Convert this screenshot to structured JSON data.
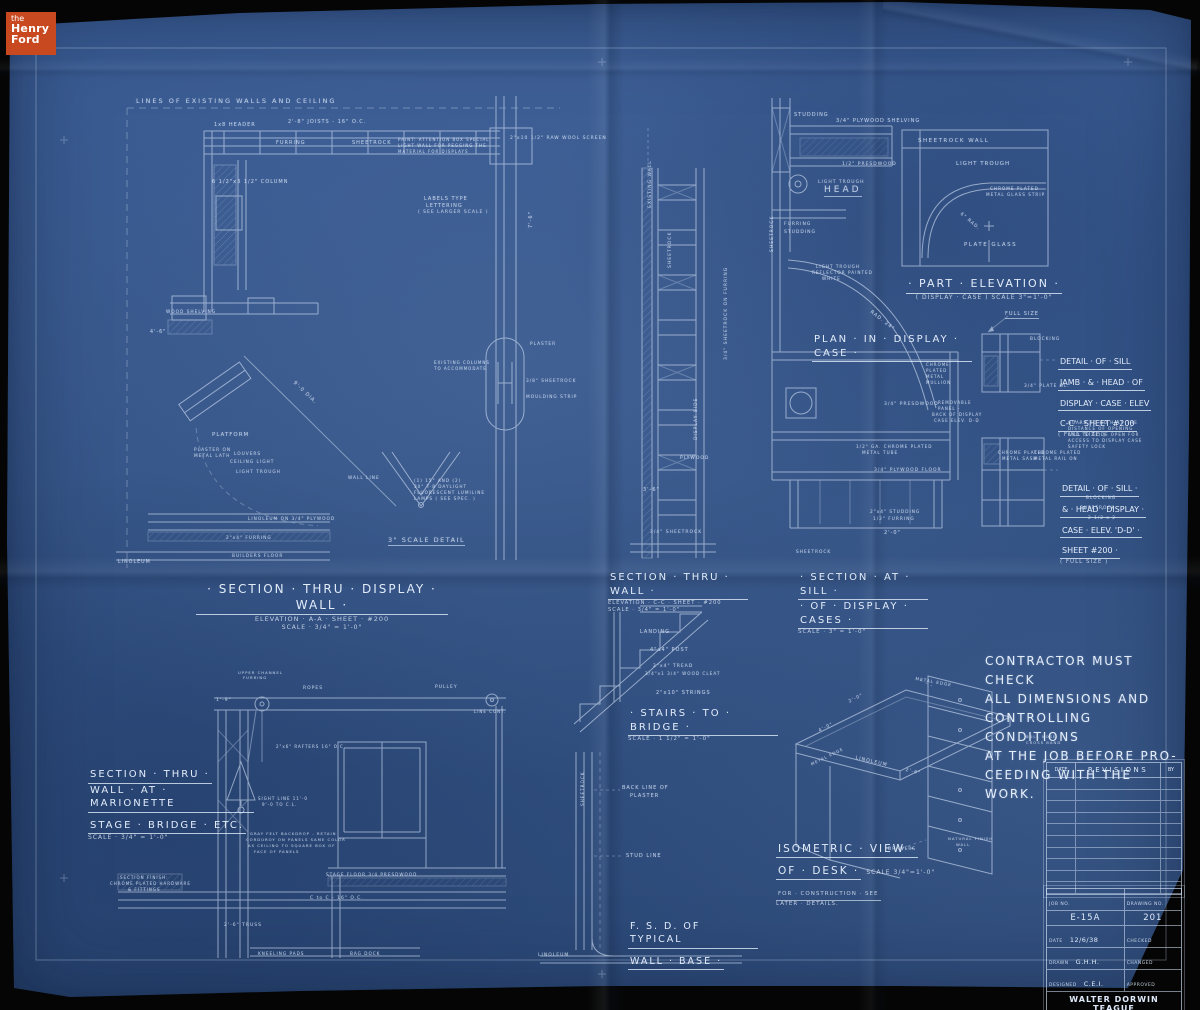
{
  "logo": {
    "the": "the",
    "henry": "Henry",
    "ford": "Ford"
  },
  "colors": {
    "paper_blue": "#35568c",
    "line_white": "#d9e6f8",
    "logo_orange": "#c8491f",
    "background_black": "#050505"
  },
  "contractor_note": {
    "lines": [
      "CONTRACTOR MUST CHECK",
      "ALL DIMENSIONS AND",
      "CONTROLLING CONDITIONS",
      "AT THE JOB BEFORE PRO-",
      "CEEDING WITH THE WORK."
    ]
  },
  "section_titles": {
    "display_wall": {
      "title": "· SECTION · THRU · DISPLAY · WALL ·",
      "sub1": "ELEVATION · A-A · SHEET · #200",
      "sub2": "SCALE · 3/4\" = 1'-0\""
    },
    "thru_wall": {
      "title": "SECTION · THRU · WALL ·",
      "sub1": "ELEVATION · C-C · SHEET · #200",
      "sub2": "SCALE · 3/4\" = 1'-0\""
    },
    "at_sill": {
      "title1": "· SECTION · AT · SILL ·",
      "title2": "· OF · DISPLAY · CASES ·",
      "sub": "SCALE · 3\" = 1'-0\""
    },
    "part_elevation": {
      "title": "· PART · ELEVATION ·",
      "sub": "( DISPLAY · CASE )  SCALE 3\"=1'-0\""
    },
    "plan_display_case": {
      "title": "PLAN · IN · DISPLAY · CASE ·"
    },
    "detail_cc": {
      "lines": [
        "DETAIL · OF · SILL",
        "JAMB · & · HEAD · OF",
        "DISPLAY · CASE · ELEV",
        "C-C' · SHEET #200"
      ],
      "tail": "( FULL SIZE )"
    },
    "detail_dd": {
      "lines": [
        "DETAIL · OF · SILL ·",
        "& · HEAD · DISPLAY ·",
        "CASE · ELEV. 'D-D' ·",
        "SHEET #200 ·"
      ],
      "tail": "( FULL SIZE )"
    },
    "stairs": {
      "title": "· STAIRS · TO · BRIDGE ·",
      "sub": "SCALE · 1 1/2\" = 1'-0\""
    },
    "marionette": {
      "line1": "SECTION · THRU ·",
      "line2": "WALL · AT · MARIONETTE",
      "line3": "STAGE · BRIDGE · ETC.",
      "sub": "SCALE · 3/4\" = 1'-0\""
    },
    "isometric_desk": {
      "line1": "ISOMETRIC · VIEW ·",
      "line2": "OF · DESK ·",
      "scale": "SCALE 3/4\"=1'-0\"",
      "sub1": "FOR · CONSTRUCTION · SEE",
      "sub2": "LATER · DETAILS."
    },
    "fsd": {
      "line1": "F. S. D. OF TYPICAL",
      "line2": "WALL · BASE ·"
    }
  },
  "revisions_table": {
    "date_header": "DATE",
    "revisions_header": "REVISIONS",
    "by_header": "BY",
    "empty_rows": 10
  },
  "title_block": {
    "job_no_label": "JOB NO.",
    "drawing_no_label": "DRAWING NO.",
    "job_no": "E-15A",
    "drawing_no": "201",
    "date_label": "DATE",
    "date": "12/6/38",
    "drawn_label": "DRAWN",
    "drawn": "G.H.H.",
    "designed_label": "DESIGNED",
    "designed": "C.E.I.",
    "checked_label": "CHECKED",
    "checked": "",
    "changed_label": "CHANGED",
    "changed": "",
    "approved_label": "APPROVED",
    "approved": "",
    "firm_line1": "WALTER DORWIN TEAGUE",
    "firm_line2": "D E S I G N E R",
    "firm_line3": "210 MADISON AVENUE",
    "firm_line4": "NEW · YORK · CITY"
  },
  "labels": [
    {
      "t": "LINES OF EXISTING WALLS AND CEILING",
      "x": 136,
      "y": 97,
      "s": 6.5,
      "ls": 2
    },
    {
      "t": "1x8 HEADER",
      "x": 214,
      "y": 122,
      "s": 5
    },
    {
      "t": "2'-8\" JOISTS - 16\" O.C.",
      "x": 288,
      "y": 119,
      "s": 5
    },
    {
      "t": "FURRING",
      "x": 276,
      "y": 140,
      "s": 5
    },
    {
      "t": "SHEETROCK",
      "x": 352,
      "y": 140,
      "s": 5
    },
    {
      "t": "PAINT: ATTENTION BOX SPECIAL",
      "x": 398,
      "y": 137,
      "s": 4
    },
    {
      "t": "LIGHT WALL FOR PEGGING THE",
      "x": 398,
      "y": 143,
      "s": 4
    },
    {
      "t": "MATERIAL FOR DISPLAYS",
      "x": 398,
      "y": 149,
      "s": 4
    },
    {
      "t": "2\"x10 1/2\" RAW WOOL SCREEN",
      "x": 510,
      "y": 136,
      "s": 4.5
    },
    {
      "t": "6 1/2\"x3 1/2\" COLUMN",
      "x": 212,
      "y": 179,
      "s": 5
    },
    {
      "t": "LABELS TYPE",
      "x": 424,
      "y": 196,
      "s": 5
    },
    {
      "t": "LETTERING",
      "x": 426,
      "y": 203,
      "s": 5
    },
    {
      "t": "( SEE LARGER SCALE )",
      "x": 418,
      "y": 210,
      "s": 4.5
    },
    {
      "t": "7'-6\"",
      "x": 528,
      "y": 228,
      "s": 5,
      "r": -90
    },
    {
      "t": "WOOD SHELVING",
      "x": 166,
      "y": 310,
      "s": 4.3
    },
    {
      "t": "4'-6\"",
      "x": 150,
      "y": 330,
      "s": 4.8
    },
    {
      "t": "PLATFORM",
      "x": 212,
      "y": 432,
      "s": 5.5,
      "ls": 1
    },
    {
      "t": "PLASTER ON",
      "x": 194,
      "y": 448,
      "s": 4.3
    },
    {
      "t": "METAL LATH",
      "x": 194,
      "y": 454,
      "s": 4.3
    },
    {
      "t": "LOUVERS",
      "x": 234,
      "y": 452,
      "s": 4.3
    },
    {
      "t": "CEILING LIGHT",
      "x": 230,
      "y": 460,
      "s": 4.3
    },
    {
      "t": "LIGHT TROUGH",
      "x": 236,
      "y": 470,
      "s": 4.3
    },
    {
      "t": "LINOLEUM ON 3/4\" PLYWOOD",
      "x": 248,
      "y": 517,
      "s": 4.3
    },
    {
      "t": "2\"x4\" FURRING",
      "x": 226,
      "y": 536,
      "s": 4.3
    },
    {
      "t": "BUILDERS FLOOR",
      "x": 232,
      "y": 554,
      "s": 4.3
    },
    {
      "t": "LINOLEUM",
      "x": 118,
      "y": 560,
      "s": 4.8
    },
    {
      "t": "9'-0 DIA.",
      "x": 296,
      "y": 380,
      "s": 5,
      "r": 44
    },
    {
      "t": "WALL LINE",
      "x": 348,
      "y": 476,
      "s": 4.3
    },
    {
      "t": "(1) 15\" AND (2)",
      "x": 414,
      "y": 478,
      "s": 4.2
    },
    {
      "t": "30\" T-8 DAYLIGHT",
      "x": 414,
      "y": 484,
      "s": 4.2
    },
    {
      "t": "FLUORESCENT LUMILINE",
      "x": 414,
      "y": 490,
      "s": 4.2
    },
    {
      "t": "LAMPS ( SEE SPEC. )",
      "x": 414,
      "y": 496,
      "s": 4.2
    },
    {
      "t": "3\" SCALE DETAIL",
      "x": 388,
      "y": 536,
      "s": 6.5,
      "u": true,
      "ls": 1.5
    },
    {
      "t": "EXISTING COLUMNS",
      "x": 434,
      "y": 360,
      "s": 4
    },
    {
      "t": "TO ACCOMMODATE",
      "x": 434,
      "y": 366,
      "s": 4
    },
    {
      "t": "PLASTER",
      "x": 530,
      "y": 342,
      "s": 4.3
    },
    {
      "t": "3/8\" SHEETROCK",
      "x": 526,
      "y": 379,
      "s": 4.3
    },
    {
      "t": "MOULDING STRIP",
      "x": 526,
      "y": 395,
      "s": 4.3
    },
    {
      "t": "EXISTING WALL",
      "x": 648,
      "y": 208,
      "s": 4.5,
      "r": -90
    },
    {
      "t": "SHEETROCK",
      "x": 668,
      "y": 268,
      "s": 4.5,
      "r": -90
    },
    {
      "t": "3/4\" SHEETROCK ON FURRING",
      "x": 724,
      "y": 360,
      "s": 4.5,
      "r": -90
    },
    {
      "t": "DISPLAY SIDE",
      "x": 694,
      "y": 440,
      "s": 4.5,
      "r": -90
    },
    {
      "t": "PLYWOOD",
      "x": 680,
      "y": 456,
      "s": 4.5
    },
    {
      "t": "3/4\" SHEETROCK",
      "x": 650,
      "y": 530,
      "s": 4.5
    },
    {
      "t": "3'-6\"",
      "x": 643,
      "y": 487,
      "s": 5
    },
    {
      "t": "STUDDING",
      "x": 794,
      "y": 112,
      "s": 5
    },
    {
      "t": "3/4\" PLYWOOD SHELVING",
      "x": 836,
      "y": 118,
      "s": 5
    },
    {
      "t": "1/2\" PRESDWOOD",
      "x": 842,
      "y": 162,
      "s": 4.5
    },
    {
      "t": "LIGHT TROUGH",
      "x": 818,
      "y": 180,
      "s": 4.5
    },
    {
      "t": "HEAD",
      "x": 824,
      "y": 185,
      "s": 9,
      "u": true,
      "ls": 3
    },
    {
      "t": "FURRING",
      "x": 784,
      "y": 222,
      "s": 4.5
    },
    {
      "t": "STUDDING",
      "x": 784,
      "y": 230,
      "s": 4.5
    },
    {
      "t": "SHEETROCK",
      "x": 770,
      "y": 252,
      "s": 4.5,
      "r": -90
    },
    {
      "t": "LIGHT TROUGH",
      "x": 816,
      "y": 264,
      "s": 4.2
    },
    {
      "t": "REFLECTOR PAINTED",
      "x": 812,
      "y": 270,
      "s": 4.2
    },
    {
      "t": "WHITE",
      "x": 822,
      "y": 276,
      "s": 4.2
    },
    {
      "t": "RAD. 24\"",
      "x": 872,
      "y": 310,
      "s": 4.8,
      "r": 38
    },
    {
      "t": "3/4\" PRESDWOOD",
      "x": 884,
      "y": 402,
      "s": 4.5
    },
    {
      "t": "CHROME",
      "x": 926,
      "y": 362,
      "s": 4
    },
    {
      "t": "PLATED",
      "x": 926,
      "y": 368,
      "s": 4
    },
    {
      "t": "METAL",
      "x": 926,
      "y": 374,
      "s": 4
    },
    {
      "t": "MULLION",
      "x": 926,
      "y": 380,
      "s": 4
    },
    {
      "t": "REMOVABLE",
      "x": 938,
      "y": 400,
      "s": 4
    },
    {
      "t": "PANEL -",
      "x": 938,
      "y": 406,
      "s": 4
    },
    {
      "t": "BACK OF DISPLAY",
      "x": 932,
      "y": 412,
      "s": 4
    },
    {
      "t": "CASE ELEV. D-D",
      "x": 934,
      "y": 418,
      "s": 4
    },
    {
      "t": "1/2\" GA. CHROME PLATED",
      "x": 856,
      "y": 444,
      "s": 4.2
    },
    {
      "t": "METAL TUBE",
      "x": 862,
      "y": 450,
      "s": 4.2
    },
    {
      "t": "3/4\" PLYWOOD FLOOR",
      "x": 874,
      "y": 468,
      "s": 4.5
    },
    {
      "t": "2\"x4\" STUDDING",
      "x": 870,
      "y": 510,
      "s": 4.3
    },
    {
      "t": "1/2\" FURRING",
      "x": 873,
      "y": 517,
      "s": 4.3
    },
    {
      "t": "2'-0\"",
      "x": 884,
      "y": 530,
      "s": 5
    },
    {
      "t": "SHEETROCK",
      "x": 796,
      "y": 550,
      "s": 4.3
    },
    {
      "t": "FULL SIZE",
      "x": 1005,
      "y": 311,
      "s": 5,
      "u": true
    },
    {
      "t": "BLOCKING",
      "x": 1030,
      "y": 337,
      "s": 4.3
    },
    {
      "t": "3/4\" PLATE GL.",
      "x": 1024,
      "y": 384,
      "s": 4.3
    },
    {
      "t": "GUARD TO GO HALF THE",
      "x": 1068,
      "y": 420,
      "s": 4
    },
    {
      "t": "DISTANCE OF OPENING",
      "x": 1068,
      "y": 426,
      "s": 4
    },
    {
      "t": "AND TO SLIDE OPEN FOR",
      "x": 1068,
      "y": 432,
      "s": 4
    },
    {
      "t": "ACCESS TO DISPLAY CASE",
      "x": 1068,
      "y": 438,
      "s": 4
    },
    {
      "t": "SAFETY LOCK",
      "x": 1068,
      "y": 444,
      "s": 4
    },
    {
      "t": "CHROME PLATED",
      "x": 998,
      "y": 450,
      "s": 4
    },
    {
      "t": "METAL SASH",
      "x": 1002,
      "y": 456,
      "s": 4
    },
    {
      "t": "CHROME PLATED",
      "x": 1034,
      "y": 450,
      "s": 4
    },
    {
      "t": "METAL RAIL ON",
      "x": 1034,
      "y": 456,
      "s": 4
    },
    {
      "t": "BLOCKING",
      "x": 1086,
      "y": 496,
      "s": 4.3
    },
    {
      "t": "SHEETROCK",
      "x": 1080,
      "y": 506,
      "s": 4.3
    },
    {
      "t": "2 1/2 x 2",
      "x": 1088,
      "y": 516,
      "s": 4.3
    },
    {
      "t": "SHEETROCK WALL",
      "x": 918,
      "y": 138,
      "s": 5.5,
      "ls": 1.5
    },
    {
      "t": "LIGHT TROUGH",
      "x": 956,
      "y": 161,
      "s": 5.5,
      "ls": 1
    },
    {
      "t": "CHROME PLATED",
      "x": 990,
      "y": 186,
      "s": 4.2
    },
    {
      "t": "METAL GLASS STRIP",
      "x": 986,
      "y": 192,
      "s": 4.2
    },
    {
      "t": "6\" RAD.",
      "x": 962,
      "y": 212,
      "s": 4.5,
      "r": 40
    },
    {
      "t": "PLATE GLASS",
      "x": 964,
      "y": 242,
      "s": 5.5,
      "ls": 1.5
    },
    {
      "t": "LANDING",
      "x": 640,
      "y": 629,
      "s": 5
    },
    {
      "t": "4\"x4\" POST",
      "x": 650,
      "y": 647,
      "s": 5
    },
    {
      "t": "2\"x4\" TREAD",
      "x": 653,
      "y": 664,
      "s": 4.5
    },
    {
      "t": "3/4\"x1 3/4\" WOOD CLEAT",
      "x": 645,
      "y": 671,
      "s": 4.2
    },
    {
      "t": "2\"x10\" STRINGS",
      "x": 656,
      "y": 690,
      "s": 5
    },
    {
      "t": "UPPER CHANNEL",
      "x": 238,
      "y": 670,
      "s": 3.8
    },
    {
      "t": "FURRING",
      "x": 243,
      "y": 675,
      "s": 3.8
    },
    {
      "t": "ROPES",
      "x": 303,
      "y": 686,
      "s": 4.5
    },
    {
      "t": "PULLEY",
      "x": 435,
      "y": 685,
      "s": 4.5
    },
    {
      "t": "LINE CONT.",
      "x": 474,
      "y": 709,
      "s": 4
    },
    {
      "t": "1'-9\"",
      "x": 216,
      "y": 698,
      "s": 4.5
    },
    {
      "t": "2\"x6\" RAFTERS 16\" O.C.",
      "x": 276,
      "y": 744,
      "s": 4
    },
    {
      "t": "SIGHT LINE 11'-0",
      "x": 258,
      "y": 796,
      "s": 4
    },
    {
      "t": "9'-0 TO C.L.",
      "x": 262,
      "y": 802,
      "s": 4
    },
    {
      "t": "GRAY FELT BACKDROP - RETAIN",
      "x": 250,
      "y": 831,
      "s": 3.8
    },
    {
      "t": "CORDUROY ON PANELS SAME COLOR",
      "x": 246,
      "y": 837,
      "s": 3.8
    },
    {
      "t": "AS CEILING TO SQUARE BOX OF",
      "x": 248,
      "y": 843,
      "s": 3.8
    },
    {
      "t": "FACE OF PANELS",
      "x": 254,
      "y": 849,
      "s": 3.8
    },
    {
      "t": "STAGE FLOOR 3/4 PRESDWOOD",
      "x": 326,
      "y": 872,
      "s": 4.2
    },
    {
      "t": "C to C - 16\" O.C.",
      "x": 310,
      "y": 896,
      "s": 4.5
    },
    {
      "t": "2'-6\" TRUSS",
      "x": 224,
      "y": 923,
      "s": 4.5
    },
    {
      "t": "SECTION FINISH:",
      "x": 120,
      "y": 875,
      "s": 4
    },
    {
      "t": "CHROME PLATED HARDWARE",
      "x": 110,
      "y": 881,
      "s": 4
    },
    {
      "t": "& FITTINGS",
      "x": 128,
      "y": 887,
      "s": 4
    },
    {
      "t": "KNEELING PADS",
      "x": 258,
      "y": 951,
      "s": 4.2
    },
    {
      "t": "BAG DOCK",
      "x": 350,
      "y": 951,
      "s": 4.2
    },
    {
      "t": "METAL EDGE",
      "x": 916,
      "y": 676,
      "s": 4.2,
      "r": 10
    },
    {
      "t": "2'-0\"",
      "x": 848,
      "y": 700,
      "s": 4.5,
      "r": -26
    },
    {
      "t": "4'-0\"",
      "x": 818,
      "y": 729,
      "s": 4.5,
      "r": -26
    },
    {
      "t": "LINOLEUM",
      "x": 856,
      "y": 756,
      "s": 4.8,
      "r": 13
    },
    {
      "t": "METAL EDGE",
      "x": 810,
      "y": 762,
      "s": 4,
      "r": -26
    },
    {
      "t": "2'-6\"",
      "x": 906,
      "y": 768,
      "s": 4.5,
      "r": 13
    },
    {
      "t": "NATURAL FINISH",
      "x": 948,
      "y": 836,
      "s": 3.8
    },
    {
      "t": "WALL",
      "x": 956,
      "y": 842,
      "s": 3.8
    },
    {
      "t": "DRAWERS",
      "x": 888,
      "y": 846,
      "s": 4.2
    },
    {
      "t": "BULL NOSE",
      "x": 1026,
      "y": 734,
      "s": 3.8
    },
    {
      "t": "CROSS BAND",
      "x": 1026,
      "y": 740,
      "s": 3.8
    },
    {
      "t": "SHEETROCK",
      "x": 580,
      "y": 806,
      "s": 4.2,
      "r": -90
    },
    {
      "t": "BACK LINE OF",
      "x": 622,
      "y": 785,
      "s": 5
    },
    {
      "t": "PLASTER",
      "x": 630,
      "y": 793,
      "s": 5
    },
    {
      "t": "STUD LINE",
      "x": 626,
      "y": 853,
      "s": 5
    },
    {
      "t": "LINOLEUM",
      "x": 538,
      "y": 953,
      "s": 4.5
    },
    {
      "t": "NOTE:",
      "x": 986,
      "y": 752,
      "s": 4,
      "o": 0.5
    }
  ]
}
